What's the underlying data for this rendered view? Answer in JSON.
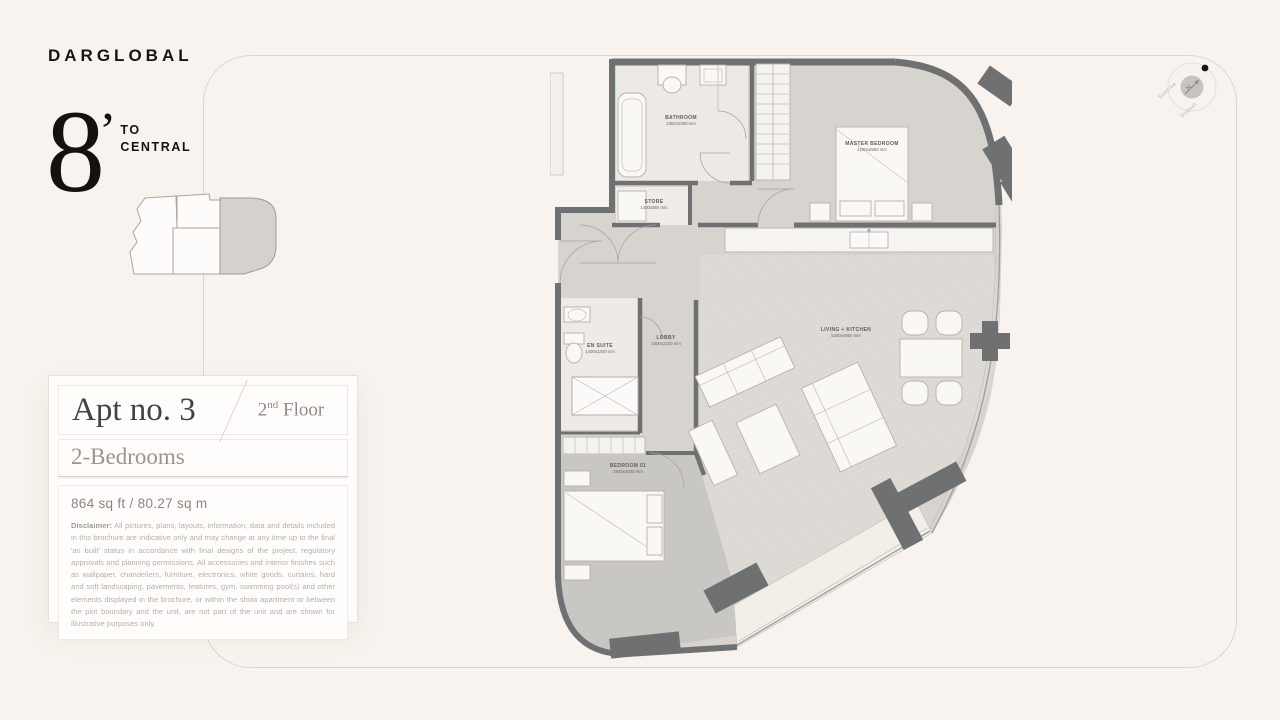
{
  "brand": {
    "logo": "DARGLOBAL",
    "numeral": "8",
    "apostrophe": "’",
    "word1": "TO",
    "word2": "CENTRAL"
  },
  "unit_card": {
    "apartment_title": "Apt no. 3",
    "floor_number": "2",
    "floor_suffix": "nd",
    "floor_word": " Floor",
    "bedrooms": "2-Bedrooms",
    "area": "864 sq ft  /  80.27 sq m",
    "disclaimer_label": "Disclaimer:",
    "disclaimer_text": " All pictures, plans, layouts, information, data and details included in this brochure are indicative only and may change at any time up to the final 'as built' status in accordance with final designs of the project, regulatory approvals and planning permissions. All accessories and interior finishes such as wallpaper, chandeliers, furniture, electronics, white goods, curtains, hard and soft landscaping, pavements, features, gym, swimming pool(s) and other elements displayed in the brochure, or within the show apartment or between the plot boundary and the unit, are not part of the unit and are shown for illustrative purposes only."
  },
  "compass": {
    "north": "N",
    "sunrise": "Sunrise",
    "sunset": "Sunset"
  },
  "floor_plan": {
    "rooms": {
      "bathroom": {
        "name": "BATHROOM",
        "dimensions": "2300x2090 mm"
      },
      "store": {
        "name": "STORE",
        "dimensions": "1400x850 mm"
      },
      "master_bedroom": {
        "name": "MASTER BEDROOM",
        "dimensions": "4180x2950 mm"
      },
      "en_suite": {
        "name": "EN SUITE",
        "dimensions": "1400x2200 mm"
      },
      "lobby": {
        "name": "LOBBY",
        "dimensions": "1000x2230 mm"
      },
      "living_kitchen": {
        "name": "LIVING + KITCHEN",
        "dimensions": "5200x4960 mm"
      },
      "bedroom_01": {
        "name": "BEDROOM 01",
        "dimensions": "2920x4000 mm"
      }
    },
    "colors": {
      "wall": "#6e7071",
      "page_background": "#f8f3ee",
      "keyplan_highlight": "#d5d1cc",
      "floor_hall": "#d7d4d0",
      "floor_living": "#dedbd6",
      "floor_bedroom": "#c9c7c3",
      "floor_wet": "#edeae5",
      "terrace": "#f2eee8"
    }
  }
}
